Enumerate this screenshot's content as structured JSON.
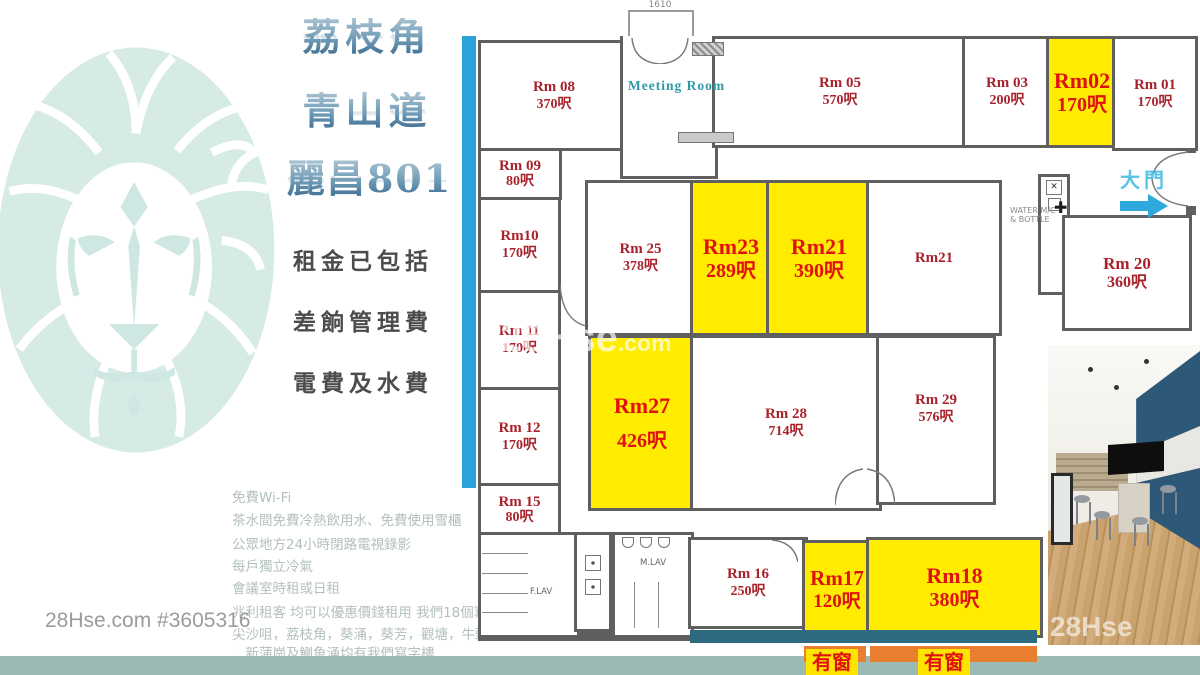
{
  "branding": {
    "listing_ref": "28Hse.com #3605316",
    "center_watermark_main": "28Hse",
    "center_watermark_suffix": ".com",
    "photo_watermark": "28Hse"
  },
  "left_panel": {
    "title_line1": "荔枝角",
    "title_line2": "青山道",
    "title_line3": "麗昌801",
    "included_line1": "租金已包括",
    "included_line2": "差餉管理費",
    "included_line3": "電費及水費",
    "features": [
      "免費Wi-Fi",
      "茶水間免費冷熱飲用水、免費使用雪櫃",
      "公眾地方24小時閉路電視錄影",
      "每戶獨立冷氣",
      "會議室時租或日租",
      "兆利租客 均可以優惠價錢租用 我們18個寫字",
      "尖沙咀，荔枝角，葵涌，葵芳，觀塘，牛頭角",
      "．新蒲崗及鰂魚涌均有我們寫字樓"
    ]
  },
  "floorplan": {
    "top_door_dimension": "1610",
    "meeting_room_label": "Meeting Room",
    "entrance_label": "大門",
    "water_label": "WATER M/C & BOTTLE",
    "female_lav_label": "F.LAV",
    "male_lav_label": "M.LAV",
    "window_label_left": "有窗",
    "window_label_right": "有窗",
    "rooms": [
      {
        "name": "Rm 08",
        "size": "370呎",
        "highlight": false
      },
      {
        "name": "Rm 05",
        "size": "570呎",
        "highlight": false
      },
      {
        "name": "Rm 03",
        "size": "200呎",
        "highlight": false
      },
      {
        "name": "Rm02",
        "size": "170呎",
        "highlight": true
      },
      {
        "name": "Rm 01",
        "size": "170呎",
        "highlight": false
      },
      {
        "name": "Rm 09",
        "size": "80呎",
        "highlight": false
      },
      {
        "name": "Rm10",
        "size": "170呎",
        "highlight": false
      },
      {
        "name": "Rm 11",
        "size": "170呎",
        "highlight": false
      },
      {
        "name": "Rm 12",
        "size": "170呎",
        "highlight": false
      },
      {
        "name": "Rm 15",
        "size": "80呎",
        "highlight": false
      },
      {
        "name": "Rm 25",
        "size": "378呎",
        "highlight": false
      },
      {
        "name": "Rm23",
        "size": "289呎",
        "highlight": true
      },
      {
        "name": "Rm21",
        "size": "390呎",
        "highlight": true
      },
      {
        "name": "Rm21",
        "size": "",
        "highlight": false
      },
      {
        "name": "Rm 20",
        "size": "360呎",
        "highlight": false
      },
      {
        "name": "Rm27",
        "size": "426呎",
        "highlight": true
      },
      {
        "name": "Rm 28",
        "size": "714呎",
        "highlight": false
      },
      {
        "name": "Rm 29",
        "size": "576呎",
        "highlight": false
      },
      {
        "name": "Rm 16",
        "size": "250呎",
        "highlight": false
      },
      {
        "name": "Rm17",
        "size": "120呎",
        "highlight": true
      },
      {
        "name": "Rm18",
        "size": "380呎",
        "highlight": true
      }
    ]
  },
  "colors": {
    "highlight_yellow": "#ffec00",
    "room_label_red": "#a8222c",
    "highlight_label_red": "#e01111",
    "window_strip_blue": "#2ba2d8",
    "window_wall_teal": "#2f6b80",
    "window_strip_orange": "#e87e2e",
    "bottom_bar_teal": "#9bbab4",
    "meeting_room_teal": "#2d9aa8",
    "entrance_blue": "#56c2e6",
    "lion_logo_teal": "#d6eae6"
  }
}
